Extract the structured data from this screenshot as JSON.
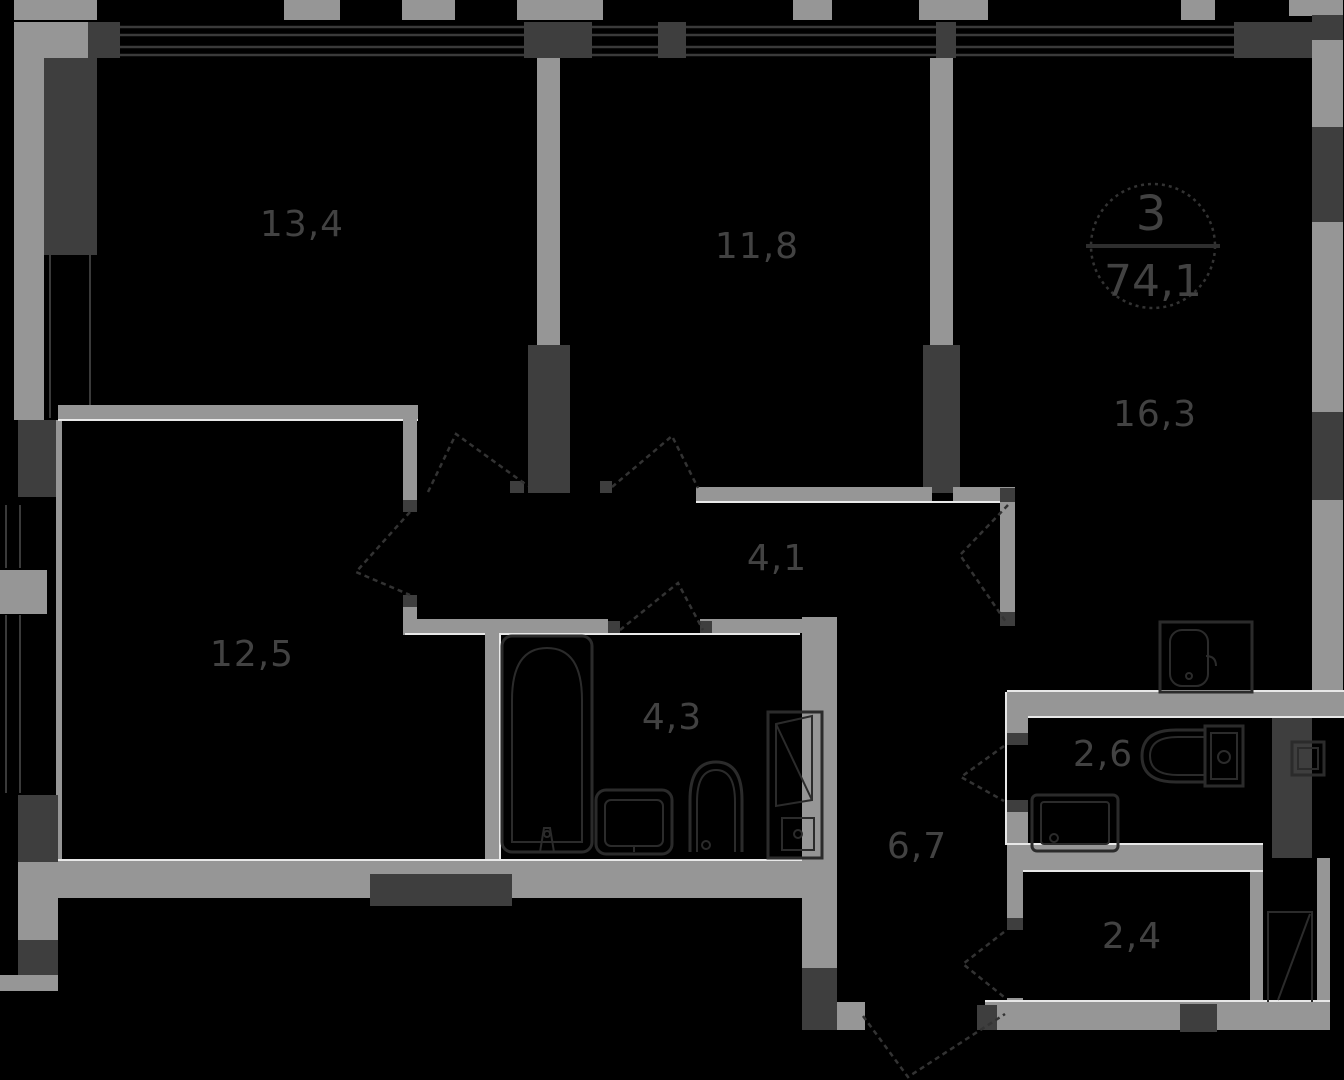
{
  "title": "apartment-floor-plan",
  "badge": {
    "unit_number": "3",
    "total_area": "74,1"
  },
  "rooms": [
    {
      "name": "bedroom-top-left",
      "area": "13,4"
    },
    {
      "name": "bedroom-top-middle",
      "area": "11,8"
    },
    {
      "name": "kitchen-living",
      "area": "16,3"
    },
    {
      "name": "hallway",
      "area": "4,1"
    },
    {
      "name": "bedroom-left",
      "area": "12,5"
    },
    {
      "name": "bathroom",
      "area": "4,3"
    },
    {
      "name": "wc",
      "area": "2,6"
    },
    {
      "name": "corridor",
      "area": "6,7"
    },
    {
      "name": "entry-hall",
      "area": "2,4"
    }
  ],
  "fixtures": [
    "bathtub",
    "bathroom-sink",
    "toilet",
    "water-heater-cabinet",
    "kitchen-sink",
    "wc-toilet",
    "washing-machine",
    "electrical-panel",
    "entry-door"
  ],
  "colors": {
    "background": "#000000",
    "wall_light": "#969696",
    "wall_dark": "#3e3e3e",
    "edge_highlight": "#e8e8e8",
    "outline": "#2b2b2b",
    "label": "#424242"
  }
}
